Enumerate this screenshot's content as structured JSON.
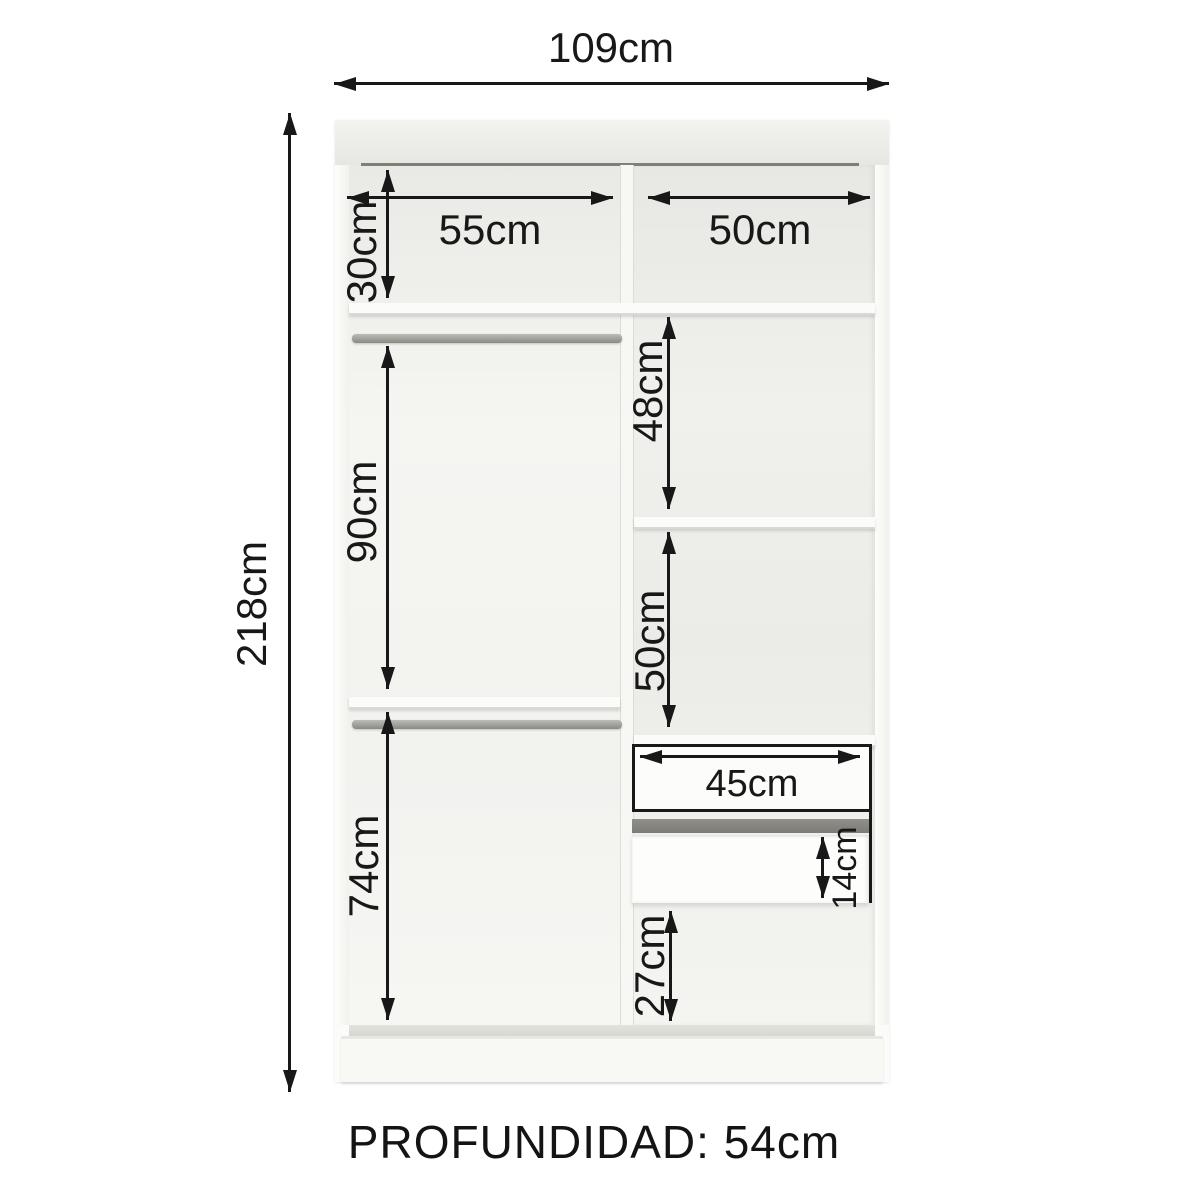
{
  "dimensions": {
    "total_width": "109cm",
    "total_height": "218cm",
    "top_left_section_width": "55cm",
    "top_right_section_width": "50cm",
    "top_section_height": "30cm",
    "upper_hanging_height": "90cm",
    "lower_hanging_height": "74cm",
    "shelf_section_upper_height": "48cm",
    "shelf_section_lower_height": "50cm",
    "drawer_width": "45cm",
    "drawer_front_height": "14cm",
    "bottom_section_height": "27cm"
  },
  "footer": {
    "depth_label": "PROFUNDIDAD: 54cm"
  }
}
